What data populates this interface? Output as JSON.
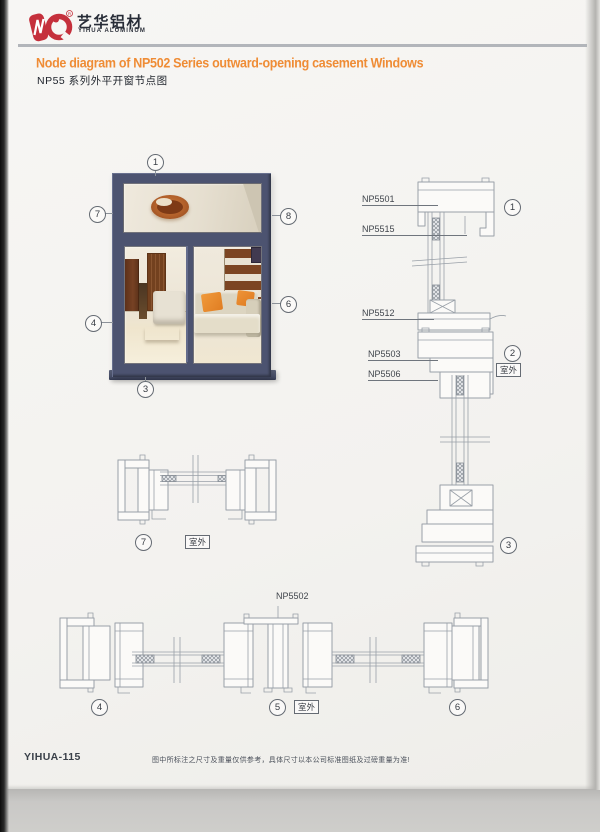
{
  "brand": {
    "logo_color": "#c5303c",
    "name_cn": "艺华铝材",
    "name_en": "YIHUA ALUMINUM",
    "registered_mark": "R"
  },
  "header": {
    "title_en": "Node diagram of NP502 Series outward-opening casement Windows",
    "title_cn": "NP55 系列外平开窗节点图",
    "accent_color": "#ef8c35"
  },
  "photo": {
    "callouts": {
      "top": "1",
      "left_upper": "7",
      "right_upper": "8",
      "left_lower": "4",
      "right_lower": "6",
      "bottom": "3"
    }
  },
  "vertical_section": {
    "labels": {
      "l1": "NP5501",
      "l2": "NP5515",
      "l3": "NP5512",
      "l4": "NP5503",
      "l5": "NP5506"
    },
    "callouts": {
      "top": "1",
      "mid": "2",
      "bottom": "3"
    },
    "outdoor": "室外"
  },
  "mid_section": {
    "callout": "7",
    "outdoor": "室外"
  },
  "bottom_section": {
    "label": "NP5502",
    "callouts": {
      "left": "4",
      "mid": "5",
      "right": "6"
    },
    "outdoor": "室外"
  },
  "footer": {
    "code": "YIHUA-115",
    "disclaimer": "图中所标注之尺寸及重量仅供参考，具体尺寸以本公司标准图纸及过磅重量为准!"
  }
}
